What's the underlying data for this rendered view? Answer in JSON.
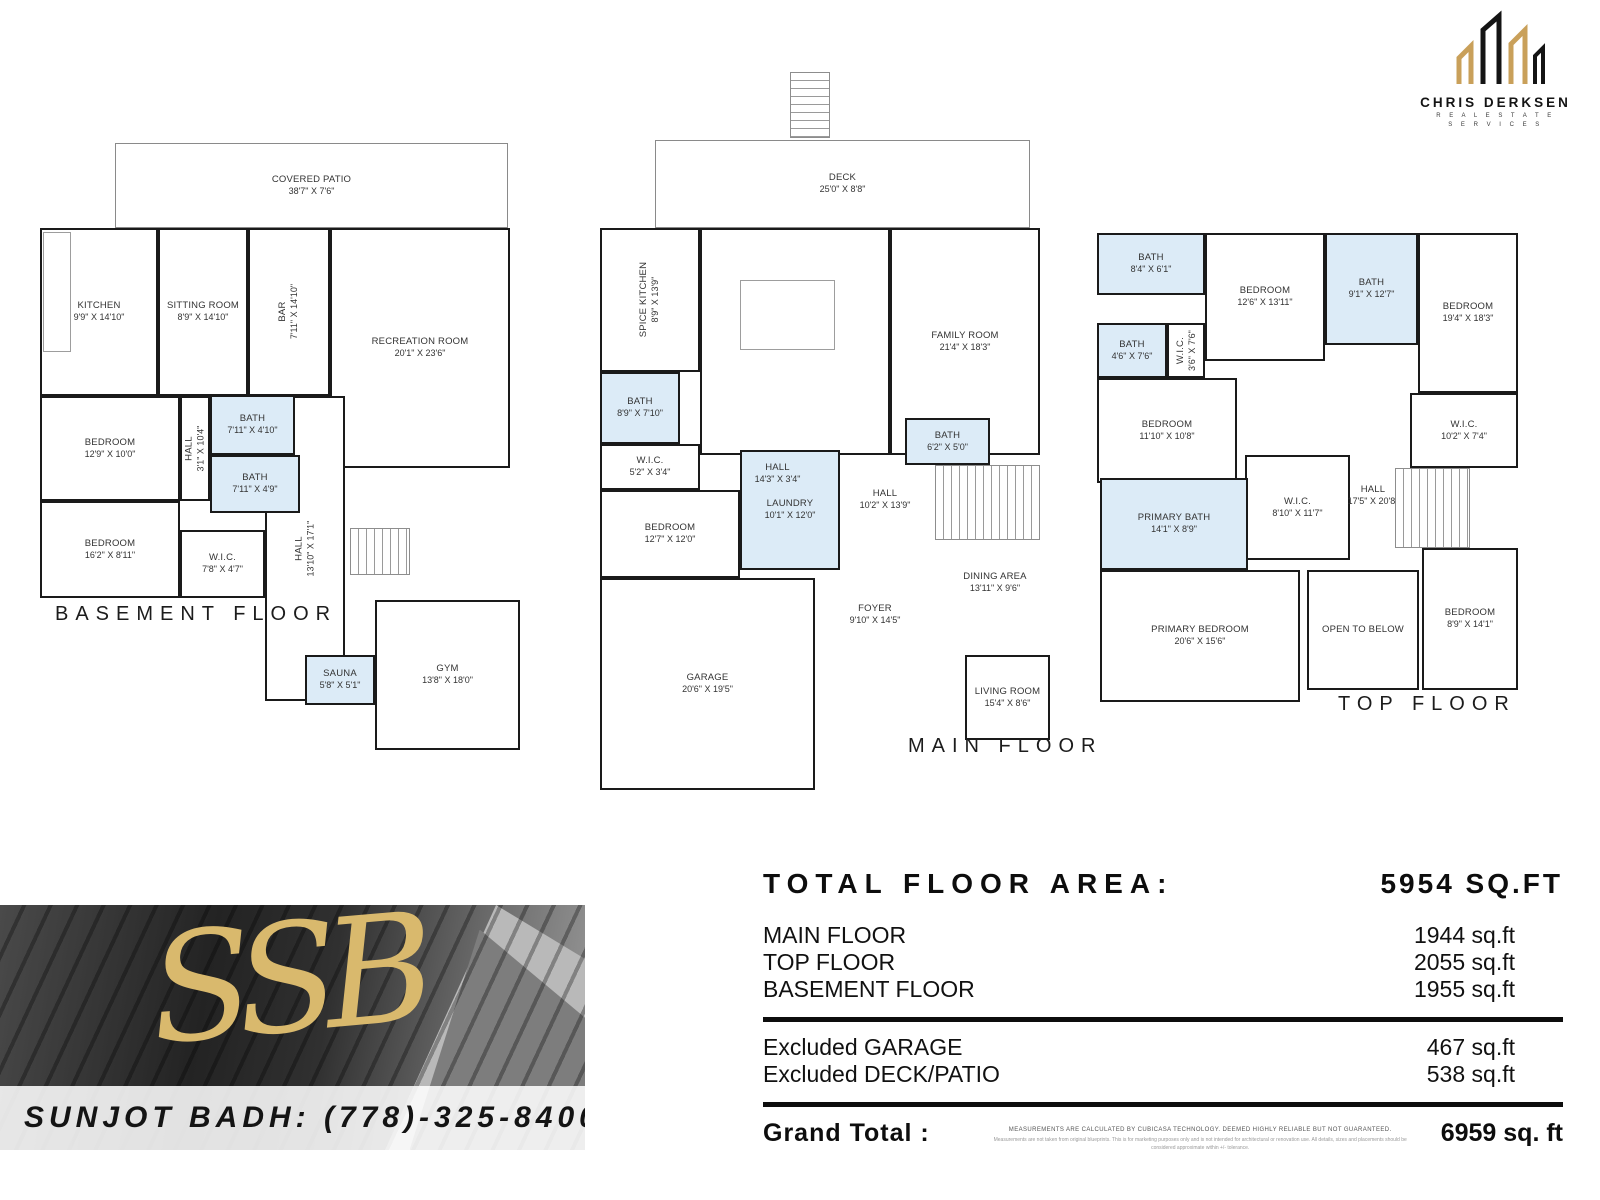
{
  "branding": {
    "logo_name": "CHRIS DERKSEN",
    "logo_subtitle_line1": "R E A L   E S T A T E",
    "logo_subtitle_line2": "S E R V I C E S",
    "monogram": "SSB",
    "agent_contact": "SUNJOT BADH: (778)-325-8400",
    "gold": "#c9a05a",
    "black": "#141414",
    "wet_room_fill": "#dcebf7"
  },
  "floors": {
    "basement": {
      "title": "BASEMENT FLOOR",
      "rooms": [
        {
          "name": "COVERED PATIO",
          "dims": "38'7\" X 7'6\""
        },
        {
          "name": "KITCHEN",
          "dims": "9'9\" X 14'10\""
        },
        {
          "name": "SITTING ROOM",
          "dims": "8'9\" X 14'10\""
        },
        {
          "name": "BAR",
          "dims": "7'11\" X 14'10\""
        },
        {
          "name": "RECREATION ROOM",
          "dims": "20'1\" X 23'6\""
        },
        {
          "name": "BATH",
          "dims": "7'11\" X 4'10\""
        },
        {
          "name": "BEDROOM",
          "dims": "12'9\" X 10'0\""
        },
        {
          "name": "HALL",
          "dims": "3'1\" X 10'4\""
        },
        {
          "name": "BATH",
          "dims": "7'11\" X 4'9\""
        },
        {
          "name": "BEDROOM",
          "dims": "16'2\" X 8'11\""
        },
        {
          "name": "W.I.C.",
          "dims": "7'8\" X 4'7\""
        },
        {
          "name": "HALL",
          "dims": "13'10\" X 17'1\""
        },
        {
          "name": "SAUNA",
          "dims": "5'8\" X 5'1\""
        },
        {
          "name": "GYM",
          "dims": "13'8\" X 18'0\""
        }
      ]
    },
    "main": {
      "title": "MAIN FLOOR",
      "rooms": [
        {
          "name": "DECK",
          "dims": "25'0\" X 8'8\""
        },
        {
          "name": "SPICE KITCHEN",
          "dims": "8'9\" X 13'9\""
        },
        {
          "name": "KITCHEN",
          "dims": "14'4\" X 18'3\""
        },
        {
          "name": "FAMILY ROOM",
          "dims": "21'4\" X 18'3\""
        },
        {
          "name": "BATH",
          "dims": "8'9\" X 7'10\""
        },
        {
          "name": "W.I.C.",
          "dims": "5'2\" X 3'4\""
        },
        {
          "name": "HALL",
          "dims": "14'3\" X 3'4\""
        },
        {
          "name": "BATH",
          "dims": "6'2\" X 5'0\""
        },
        {
          "name": "HALL",
          "dims": "10'2\" X 13'9\""
        },
        {
          "name": "LAUNDRY",
          "dims": "10'1\" X 12'0\""
        },
        {
          "name": "BEDROOM",
          "dims": "12'7\" X 12'0\""
        },
        {
          "name": "GARAGE",
          "dims": "20'6\" X 19'5\""
        },
        {
          "name": "FOYER",
          "dims": "9'10\" X 14'5\""
        },
        {
          "name": "DINING AREA",
          "dims": "13'11\" X 9'6\""
        },
        {
          "name": "LIVING ROOM",
          "dims": "15'4\" X 8'6\""
        }
      ]
    },
    "top": {
      "title": "TOP FLOOR",
      "rooms": [
        {
          "name": "BATH",
          "dims": "8'4\" X 6'1\""
        },
        {
          "name": "BEDROOM",
          "dims": "12'6\" X 13'11\""
        },
        {
          "name": "BATH",
          "dims": "9'1\" X 12'7\""
        },
        {
          "name": "BEDROOM",
          "dims": "19'4\" X 18'3\""
        },
        {
          "name": "BATH",
          "dims": "4'6\" X 7'6\""
        },
        {
          "name": "W.I.C.",
          "dims": "3'6\" X 7'6\""
        },
        {
          "name": "BEDROOM",
          "dims": "11'10\" X 10'8\""
        },
        {
          "name": "W.I.C.",
          "dims": "10'2\" X 7'4\""
        },
        {
          "name": "W.I.C.",
          "dims": "8'10\" X 11'7\""
        },
        {
          "name": "HALL",
          "dims": "17'5\" X 20'8\""
        },
        {
          "name": "PRIMARY BATH",
          "dims": "14'1\" X 8'9\""
        },
        {
          "name": "PRIMARY BEDROOM",
          "dims": "20'6\" X 15'6\""
        },
        {
          "name": "OPEN TO BELOW",
          "dims": ""
        },
        {
          "name": "BEDROOM",
          "dims": "8'9\" X 14'1\""
        }
      ]
    }
  },
  "summary": {
    "heading": "TOTAL FLOOR AREA:",
    "heading_value": "5954 SQ.FT",
    "rows": [
      {
        "label": "MAIN FLOOR",
        "value": "1944 sq.ft"
      },
      {
        "label": "TOP FLOOR",
        "value": "2055 sq.ft"
      },
      {
        "label": "BASEMENT FLOOR",
        "value": "1955 sq.ft"
      }
    ],
    "excluded": [
      {
        "label": "Excluded GARAGE",
        "value": "467 sq.ft"
      },
      {
        "label": "Excluded DECK/PATIO",
        "value": "538 sq.ft"
      }
    ],
    "grand_total_label": "Grand Total  :",
    "grand_total_value": "6959 sq. ft",
    "disclaimer_line1": "MEASUREMENTS ARE CALCULATED BY CUBICASA TECHNOLOGY. DEEMED HIGHLY RELIABLE BUT NOT GUARANTEED.",
    "disclaimer_line2": "Measurements are not taken from original blueprints. This is for marketing purposes only and is not intended for architectural or renovation use. All details, sizes and placements should be considered approximate within +/- tolerance."
  }
}
